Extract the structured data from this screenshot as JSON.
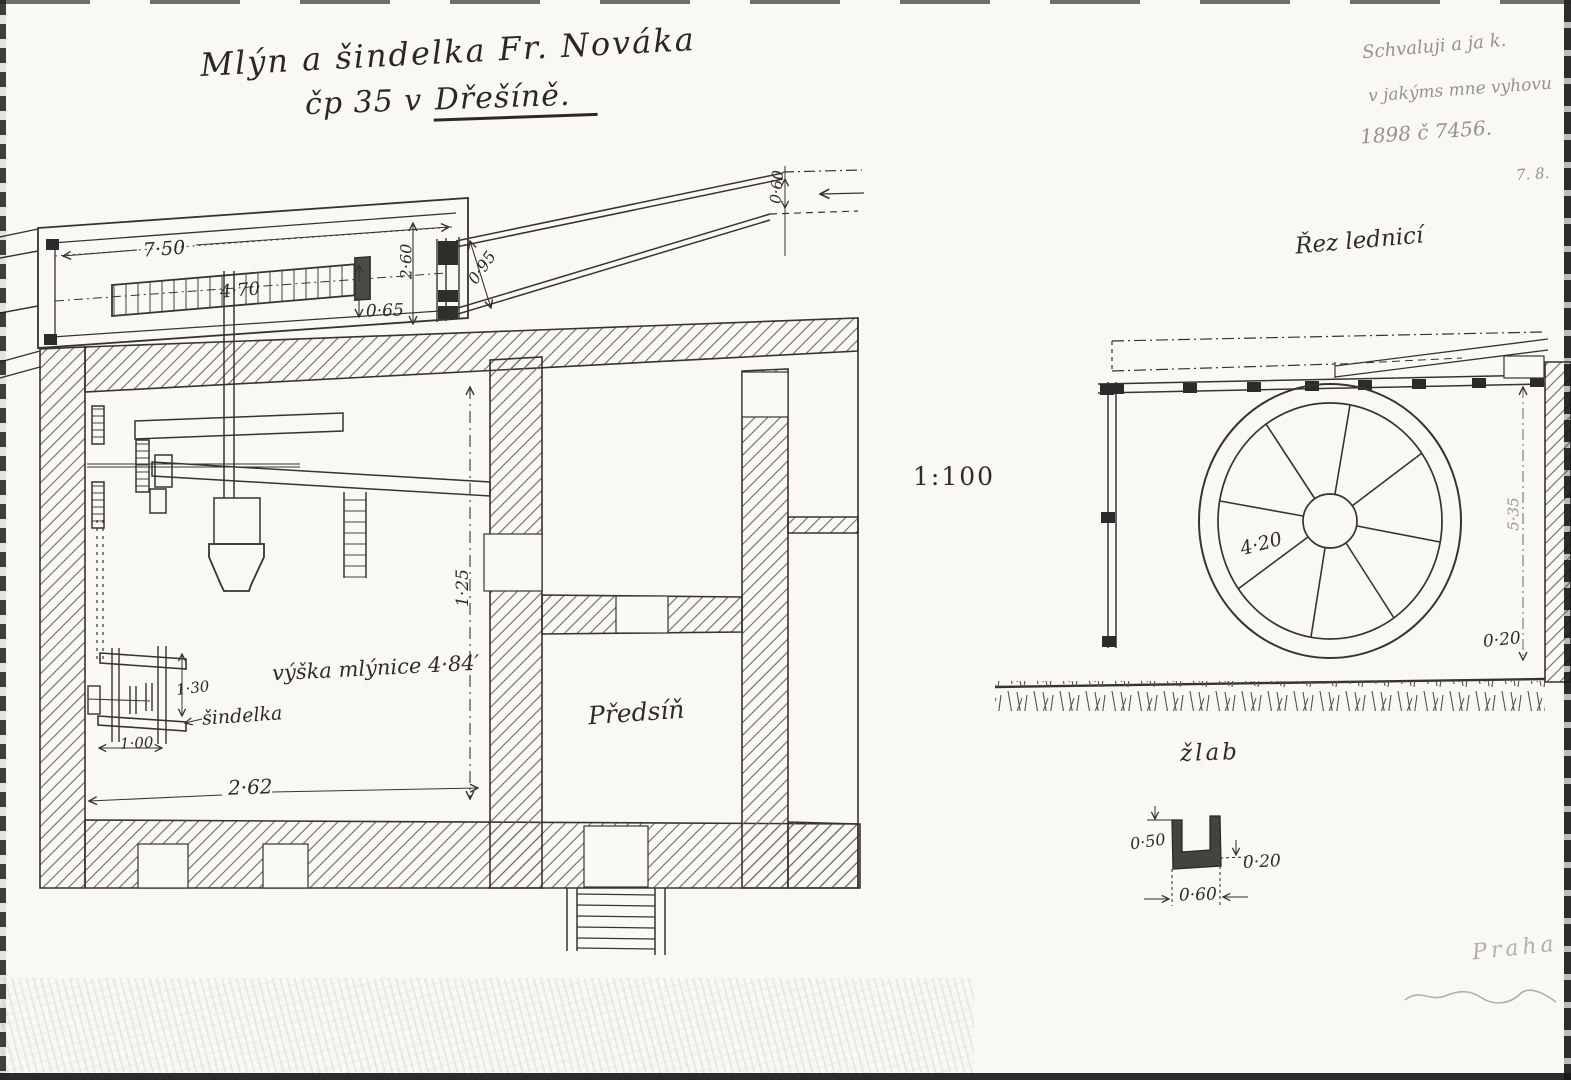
{
  "title": {
    "line1": "Mlýn a šindelka Fr. Nováka",
    "line2_prefix": "čp 35 v",
    "line2_place": "Dřešíně."
  },
  "approval_note": {
    "line1": "Schvaluji a ja k.",
    "line2": "v jakýms mne vyhovu",
    "line3": "1898 č 7456.",
    "line4": "7. 8."
  },
  "scale_label": "1:100",
  "section_view": {
    "room_label": "Předsíň",
    "height_note": "výška mlýnice 4·84′",
    "machine_label": "šindelka",
    "dims": {
      "flume_length": "7·50",
      "channel_length": "4·70",
      "channel_depth": "0·65",
      "flume_height": "2·60",
      "gate": "0·95",
      "chute": "0·60",
      "story_height": "1·25",
      "room_width": "2·62",
      "machine_height": "1·30",
      "machine_width": "1·00"
    }
  },
  "wheel_view": {
    "title": "Řez lednicí",
    "dims": {
      "wheel_diameter": "4·20",
      "height": "5·35",
      "offset": "0·20"
    }
  },
  "trough_detail": {
    "title": "žlab",
    "dims": {
      "depth": "0·50",
      "wall": "0·20",
      "width": "0·60"
    }
  },
  "footer": {
    "place": "Praha"
  }
}
